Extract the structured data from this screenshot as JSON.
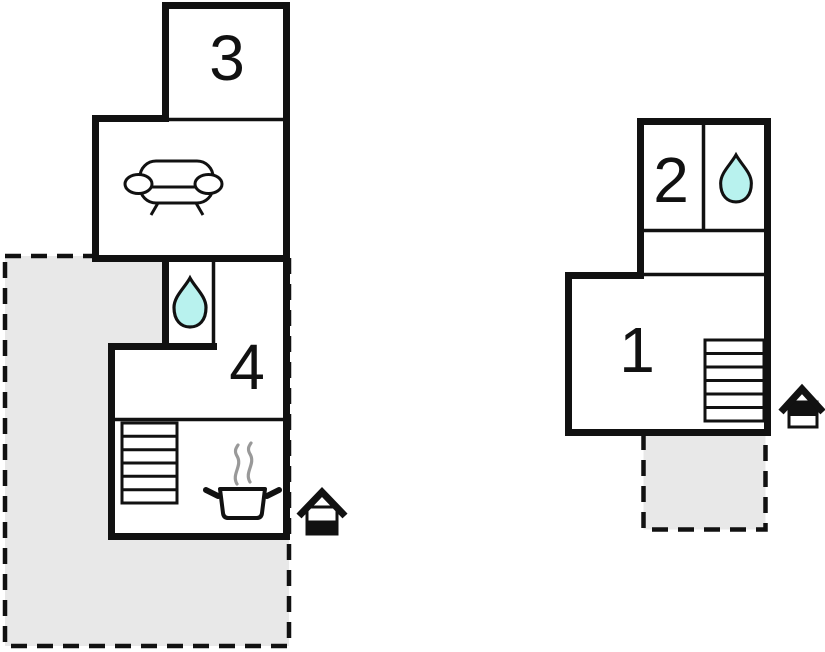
{
  "colors": {
    "wall": "#111111",
    "room_fill": "#ffffff",
    "terrace_fill": "#e8e8e8",
    "water": "#b8f2ee",
    "steam": "#999999",
    "background": "#ffffff"
  },
  "buildings": {
    "left": {
      "rooms": [
        {
          "id": "room-3",
          "label": "3"
        },
        {
          "id": "living-room",
          "label": "",
          "features": [
            "sofa-icon"
          ]
        },
        {
          "id": "bathroom",
          "label": "",
          "features": [
            "water-drop-icon"
          ]
        },
        {
          "id": "room-4",
          "label": "4"
        },
        {
          "id": "kitchen",
          "label": "",
          "features": [
            "stairs-icon",
            "cooking-pot-icon"
          ]
        }
      ],
      "entrance": {
        "icon": "entrance-icon",
        "filled_part": "bottom"
      },
      "terrace": {
        "id": "terrace-left",
        "style": "dashed-gray"
      }
    },
    "right": {
      "rooms": [
        {
          "id": "room-2",
          "label": "2"
        },
        {
          "id": "bathroom",
          "label": "",
          "features": [
            "water-drop-icon"
          ]
        },
        {
          "id": "hallway",
          "label": ""
        },
        {
          "id": "room-1",
          "label": "1",
          "features": [
            "stairs-icon"
          ]
        }
      ],
      "entrance": {
        "icon": "entrance-icon",
        "filled_part": "top"
      },
      "terrace": {
        "id": "terrace-right",
        "style": "dashed-gray"
      }
    }
  }
}
